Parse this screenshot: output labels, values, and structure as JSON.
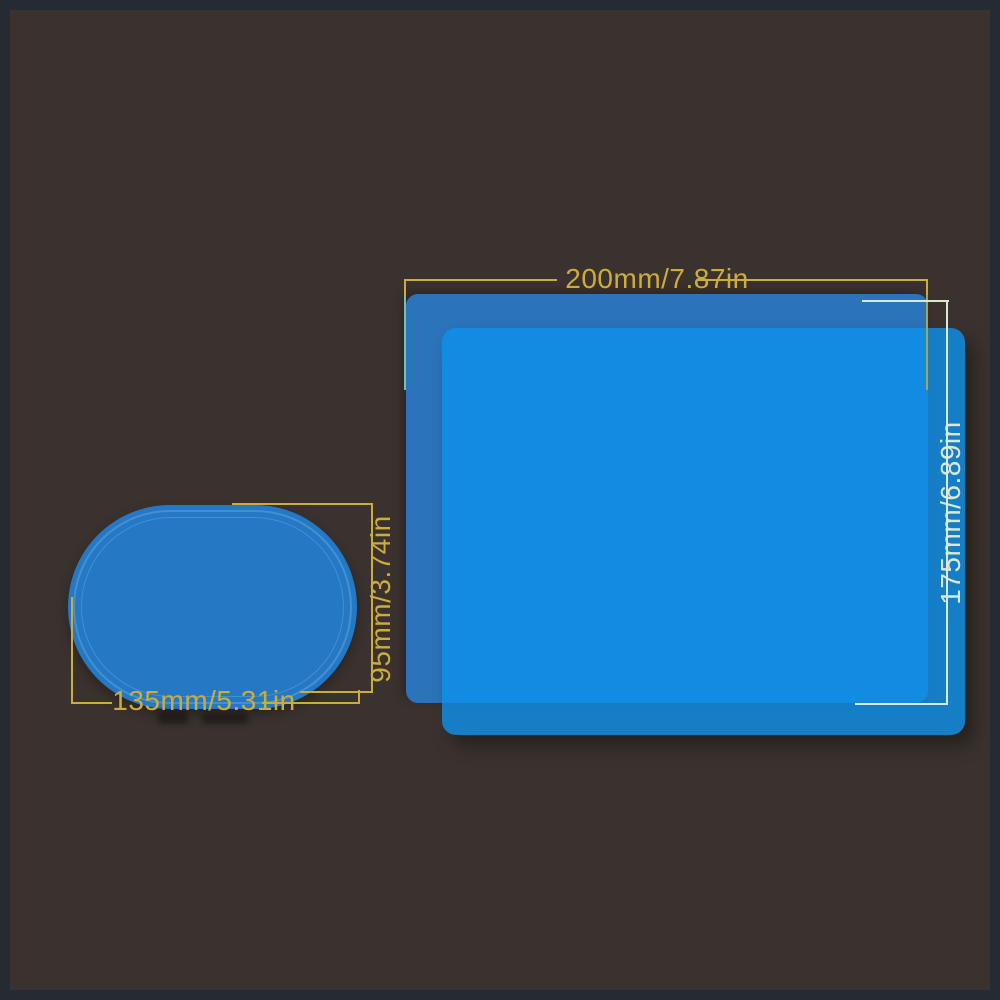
{
  "scene": {
    "description": "product dimension diagram with two blue protective films",
    "figures": {
      "large_film": {
        "shape": "rounded-rectangle",
        "width_label": "200mm/7.87in",
        "height_label": "175mm/6.89in"
      },
      "small_film": {
        "shape": "oval",
        "width_label": "135mm/5.31in",
        "height_label": "95mm/3.74in"
      }
    }
  },
  "colors": {
    "bg": "#3a322e",
    "frame": "#262a31",
    "film-back": "rgba(42,122,202,0.9)",
    "film-front": "rgba(13,145,238,0.8)",
    "oval": "#2478c4",
    "ring": "rgba(150,205,248,0.28)",
    "gold": "#ceac3c",
    "gold-soft": "#a8a455",
    "gold-teal": "#74c2ac",
    "pale": "#dce8d2",
    "smudge": "rgba(18,15,13,0.55)"
  }
}
